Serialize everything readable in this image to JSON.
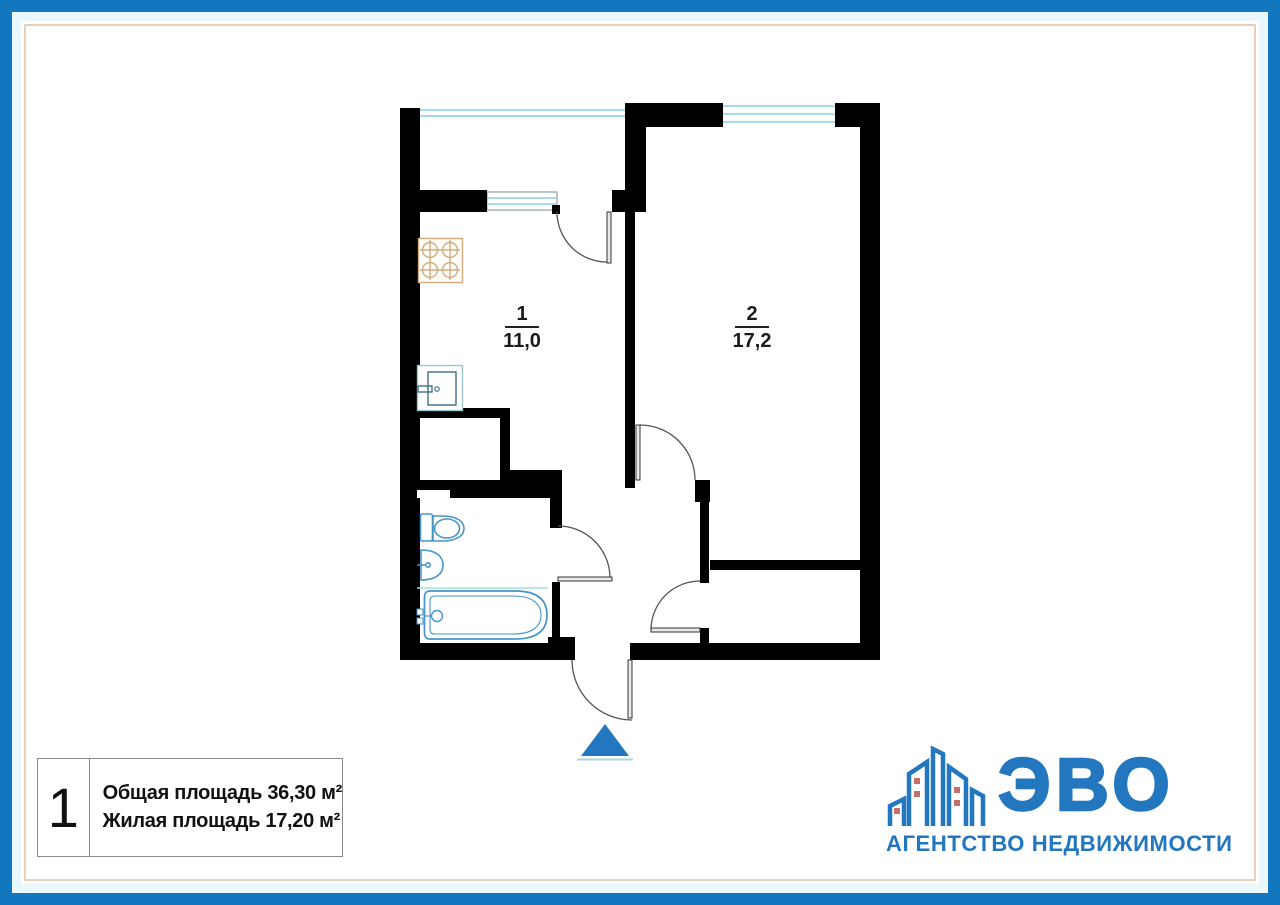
{
  "plan": {
    "rooms": [
      {
        "number": "1",
        "area": "11,0"
      },
      {
        "number": "2",
        "area": "17,2"
      }
    ],
    "fixtures": [
      "stove-icon",
      "kitchen-sink-icon",
      "toilet-icon",
      "washbasin-icon",
      "bathtub-icon"
    ],
    "entrance_marker": "triangle-up-arrow"
  },
  "info_box": {
    "plan_number": "1",
    "total_area_line": "Общая площадь 36,30 м²",
    "living_area_line": "Жилая площадь 17,20 м²"
  },
  "logo": {
    "wordmark": "ЭВО",
    "subtitle": "АГЕНТСТВО НЕДВИЖИМОСТИ"
  },
  "colors": {
    "frame_blue": "#1377c0",
    "frame_band": "#eaf7fd",
    "frame_inner_line": "#ecd0b6",
    "brand_blue": "#2377bf",
    "logo_window_red": "#c4706a",
    "window_cyan": "#a9dce6",
    "fixture_blue": "#4596c8",
    "stove_tan": "#d2ab7e",
    "wall_black": "#000000"
  }
}
